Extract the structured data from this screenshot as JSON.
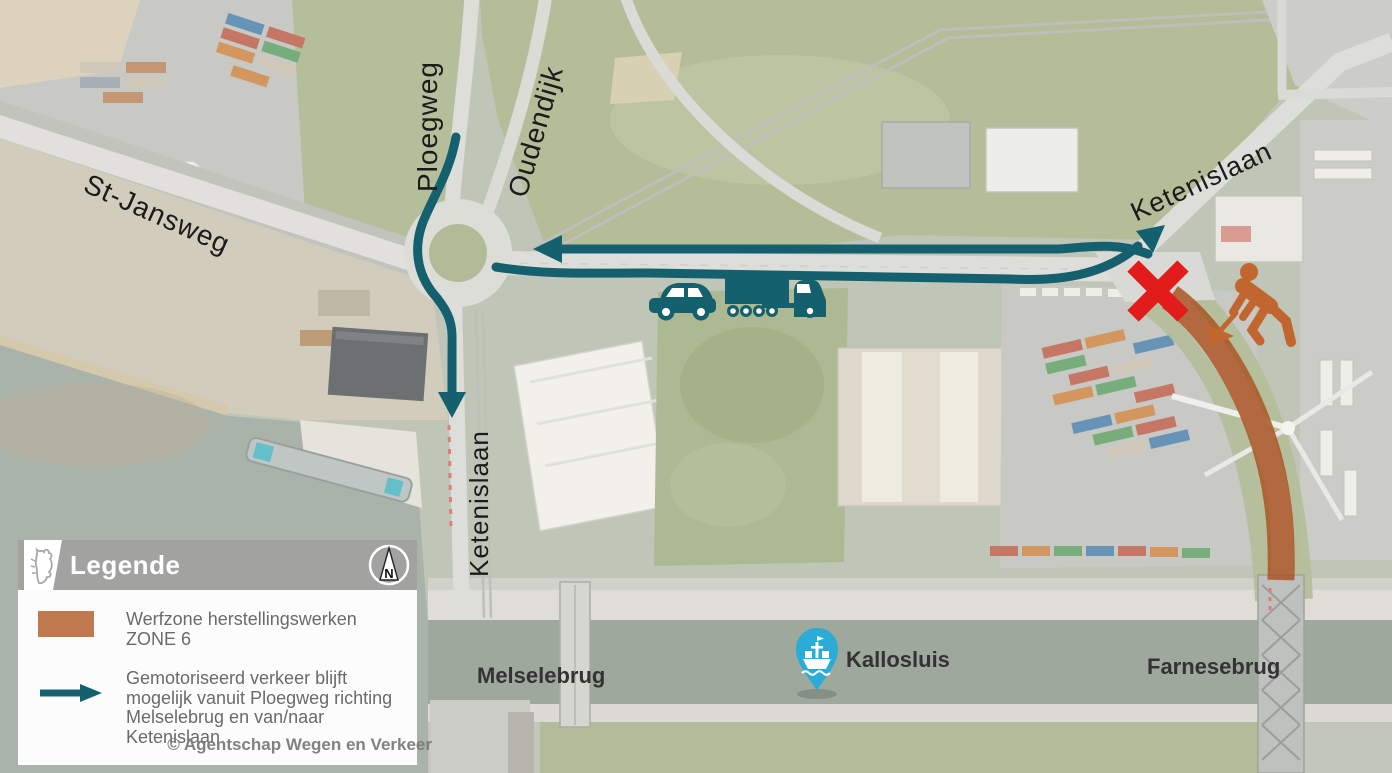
{
  "labels": {
    "st_jansweg": "St-Jansweg",
    "ploegweg": "Ploegweg",
    "oudendijk": "Oudendijk",
    "ketenislaan_ne": "Ketenislaan",
    "ketenislaan_south": "Ketenislaan",
    "melselebrug": "Melselebrug",
    "farnesebrug": "Farnesebrug",
    "kallosluis": "Kallosluis"
  },
  "legend": {
    "title": "Legende",
    "north": "N",
    "workzone_label": "Werfzone herstellingswerken ZONE 6",
    "traffic_label": "Gemotoriseerd verkeer blijft mogelijk vanuit Ploegweg richting Melselebrug en van/naar Ketenislaan"
  },
  "credit": "© Agentschap Wegen en Verkeer",
  "colors": {
    "route_teal": "#15606F",
    "workzone_orange": "#A9511E",
    "legend_swatch_orange": "#C17A50",
    "closed_red": "#E21B1B",
    "worker_orange": "#C2662F",
    "pin_blue": "#2BACD7",
    "legend_header_gray": "#A2A2A0",
    "label_black": "#1B1B1B"
  },
  "icons": {
    "north_compass": "north-arrow-in-circle",
    "flanders_lion": "flanders-lion-logo",
    "car": "passenger-car-silhouette",
    "truck": "semi-truck-silhouette",
    "worker": "roadworks-digging-worker",
    "closed_x": "road-closed-red-x",
    "ship_pin": "ship-lock-map-pin"
  }
}
